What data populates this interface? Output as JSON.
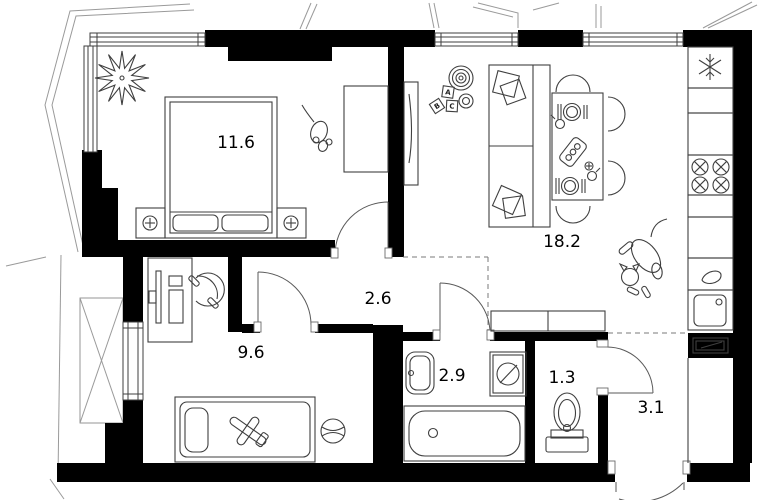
{
  "plan": {
    "rooms": [
      {
        "name": "bedroom",
        "area": "11.6"
      },
      {
        "name": "living-kitchen",
        "area": "18.2"
      },
      {
        "name": "hallway",
        "area": "2.6"
      },
      {
        "name": "kids-room",
        "area": "9.6"
      },
      {
        "name": "bathroom",
        "area": "2.9"
      },
      {
        "name": "wc",
        "area": "1.3"
      },
      {
        "name": "entry-hall",
        "area": "3.1"
      }
    ],
    "toy_blocks": [
      "A",
      "B",
      "C"
    ],
    "colors": {
      "wall": "#000000",
      "furniture_line": "#3f3f3f",
      "facade_line": "#9a9a9a",
      "background": "#ffffff"
    },
    "icons": [
      "plant-icon",
      "mouse-icon",
      "cat-icon",
      "snowflake-fridge-icon",
      "stove-burners-icon",
      "toy-rings-icon",
      "toy-blocks-icon",
      "toy-plane-icon",
      "ball-icon",
      "headphones-icon",
      "washing-machine-icon",
      "vent-shaft-icon"
    ]
  }
}
